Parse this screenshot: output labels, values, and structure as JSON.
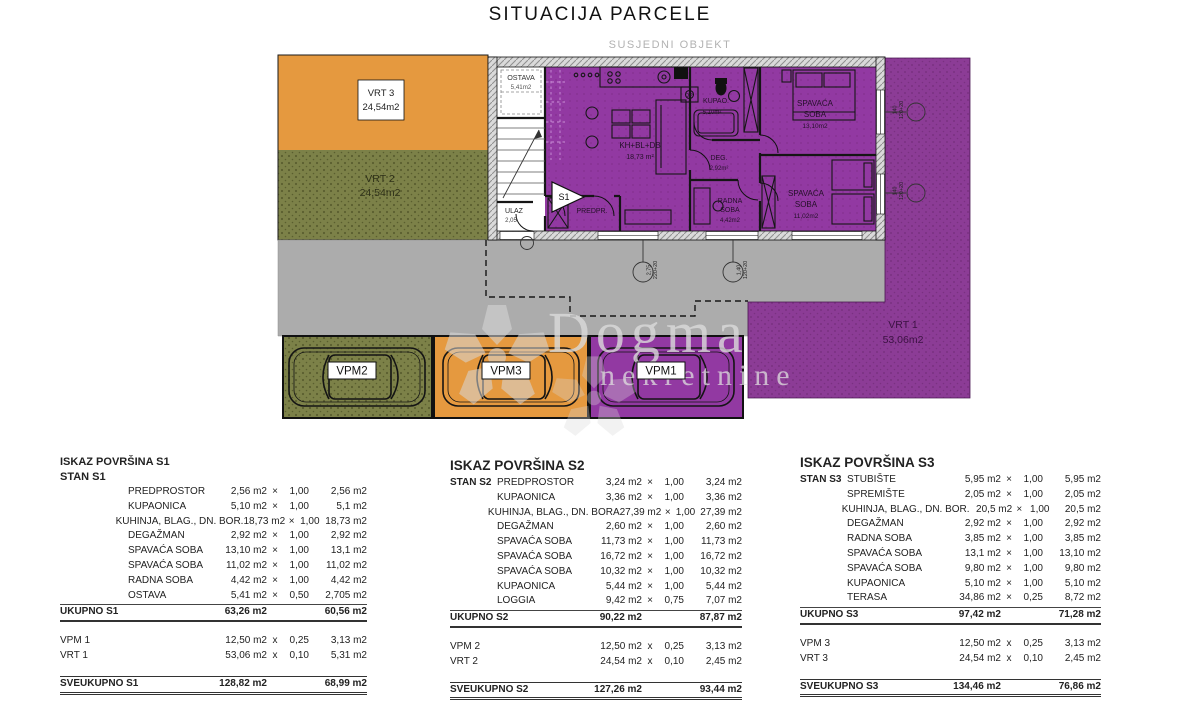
{
  "title": "SITUACIJA PARCELE",
  "site": {
    "neighbor_label": "SUSJEDNI OBJEKT",
    "watermark": {
      "brand": "Dogma",
      "brand2": "nekretnine"
    },
    "areas": {
      "vrt3": {
        "name": "VRT 3",
        "area": "24,54m2"
      },
      "vrt2": {
        "name": "VRT 2",
        "area": "24,54m2"
      },
      "vrt1": {
        "name": "VRT 1",
        "area": "53,06m2"
      }
    },
    "parking": [
      {
        "label": "VPM2"
      },
      {
        "label": "VPM3"
      },
      {
        "label": "VPM1"
      }
    ],
    "plan_labels": {
      "ostava": "OSTAVA",
      "ostava_area": "5,41m2",
      "ulaz": "ULAZ",
      "ulaz_dim": "2,05",
      "marker": "S1",
      "predprostor": "PREDPR.",
      "living": "KH+BL+DB",
      "living_area": "18,73 m²",
      "dp": "DP",
      "kupaonica": "KUPAO.",
      "kupaonica_area": "5,10m²",
      "deg": "DEG.",
      "deg_area": "2,92m²",
      "radna_1": "RADNA",
      "soba": "SOBA",
      "radna_area": "4,42m2",
      "spavaca": "SPAVAĆA",
      "spavaca1_area": "13,10m2",
      "spavaca2_area": "11,02m2"
    },
    "dims": {
      "b1_w": "2,75",
      "b1_h": "220+20",
      "b2_w": "1,40",
      "b2_h": "120+20",
      "r1_w": "140",
      "r1_h": "120+20",
      "r2_w": "140",
      "r2_h": "120+20"
    },
    "colors": {
      "orange": "#E5993F",
      "olive": "#7C8148",
      "purple_plan": "#9239A2",
      "purple_garden": "#8C3C96",
      "driveway_gray": "#ACACAC"
    }
  },
  "tables": [
    {
      "title": "ISKAZ POVRŠINA S1",
      "subtitle": "STAN S1",
      "rows": [
        {
          "g": "",
          "label": "PREDPROSTOR",
          "v": "2,56 m2",
          "m": "×",
          "f": "1,00",
          "r": "2,56 m2"
        },
        {
          "g": "",
          "label": "KUPAONICA",
          "v": "5,10 m2",
          "m": "×",
          "f": "1,00",
          "r": "5,1 m2"
        },
        {
          "g": "",
          "label": "KUHINJA, BLAG., DN. BOR.",
          "v": "18,73 m2",
          "m": "×",
          "f": "1,00",
          "r": "18,73 m2"
        },
        {
          "g": "",
          "label": "DEGAŽMAN",
          "v": "2,92 m2",
          "m": "×",
          "f": "1,00",
          "r": "2,92 m2"
        },
        {
          "g": "",
          "label": "SPAVAĆA SOBA",
          "v": "13,10 m2",
          "m": "×",
          "f": "1,00",
          "r": "13,1 m2"
        },
        {
          "g": "",
          "label": "SPAVAĆA SOBA",
          "v": "11,02 m2",
          "m": "×",
          "f": "1,00",
          "r": "11,02 m2"
        },
        {
          "g": "",
          "label": "RADNA SOBA",
          "v": "4,42 m2",
          "m": "×",
          "f": "1,00",
          "r": "4,42 m2"
        },
        {
          "g": "",
          "label": "OSTAVA",
          "v": "5,41 m2",
          "m": "×",
          "f": "0,50",
          "r": "2,705 m2"
        }
      ],
      "total": {
        "label": "UKUPNO S1",
        "v": "63,26 m2",
        "r": "60,56 m2"
      },
      "extras": [
        {
          "label": "VPM 1",
          "v": "12,50 m2",
          "m": "x",
          "f": "0,25",
          "r": "3,13 m2"
        },
        {
          "label": "VRT 1",
          "v": "53,06 m2",
          "m": "x",
          "f": "0,10",
          "r": "5,31 m2"
        }
      ],
      "grand": {
        "label": "SVEUKUPNO S1",
        "v": "128,82 m2",
        "r": "68,99 m2"
      }
    },
    {
      "title": "ISKAZ POVRŠINA S2",
      "subtitle": "",
      "rows": [
        {
          "g": "STAN S2",
          "label": "PREDPROSTOR",
          "v": "3,24 m2",
          "m": "×",
          "f": "1,00",
          "r": "3,24 m2"
        },
        {
          "g": "",
          "label": "KUPAONICA",
          "v": "3,36 m2",
          "m": "×",
          "f": "1,00",
          "r": "3,36 m2"
        },
        {
          "g": "",
          "label": "KUHINJA, BLAG., DN. BORA",
          "v": "27,39 m2",
          "m": "×",
          "f": "1,00",
          "r": "27,39 m2"
        },
        {
          "g": "",
          "label": "DEGAŽMAN",
          "v": "2,60 m2",
          "m": "×",
          "f": "1,00",
          "r": "2,60 m2"
        },
        {
          "g": "",
          "label": "SPAVAĆA SOBA",
          "v": "11,73 m2",
          "m": "×",
          "f": "1,00",
          "r": "11,73 m2"
        },
        {
          "g": "",
          "label": "SPAVAĆA SOBA",
          "v": "16,72 m2",
          "m": "×",
          "f": "1,00",
          "r": "16,72 m2"
        },
        {
          "g": "",
          "label": "SPAVAĆA SOBA",
          "v": "10,32 m2",
          "m": "×",
          "f": "1,00",
          "r": "10,32 m2"
        },
        {
          "g": "",
          "label": "KUPAONICA",
          "v": "5,44 m2",
          "m": "×",
          "f": "1,00",
          "r": "5,44 m2"
        },
        {
          "g": "",
          "label": "LOGGIA",
          "v": "9,42 m2",
          "m": "×",
          "f": "0,75",
          "r": "7,07 m2"
        }
      ],
      "total": {
        "label": "UKUPNO S2",
        "v": "90,22 m2",
        "r": "87,87 m2"
      },
      "extras": [
        {
          "label": "VPM 2",
          "v": "12,50 m2",
          "m": "x",
          "f": "0,25",
          "r": "3,13 m2"
        },
        {
          "label": "VRT 2",
          "v": "24,54 m2",
          "m": "x",
          "f": "0,10",
          "r": "2,45 m2"
        }
      ],
      "grand": {
        "label": "SVEUKUPNO S2",
        "v": "127,26 m2",
        "r": "93,44 m2"
      }
    },
    {
      "title": "ISKAZ POVRŠINA S3",
      "subtitle": "",
      "rows": [
        {
          "g": "STAN S3",
          "label": "STUBIŠTE",
          "v": "5,95 m2",
          "m": "×",
          "f": "1,00",
          "r": "5,95 m2"
        },
        {
          "g": "",
          "label": "SPREMIŠTE",
          "v": "2,05 m2",
          "m": "×",
          "f": "1,00",
          "r": "2,05 m2"
        },
        {
          "g": "",
          "label": "KUHINJA, BLAG., DN. BOR.",
          "v": "20,5 m2",
          "m": "×",
          "f": "1,00",
          "r": "20,5 m2"
        },
        {
          "g": "",
          "label": "DEGAŽMAN",
          "v": "2,92 m2",
          "m": "×",
          "f": "1,00",
          "r": "2,92 m2"
        },
        {
          "g": "",
          "label": "RADNA SOBA",
          "v": "3,85 m2",
          "m": "×",
          "f": "1,00",
          "r": "3,85 m2"
        },
        {
          "g": "",
          "label": "SPAVAĆA SOBA",
          "v": "13,1 m2",
          "m": "×",
          "f": "1,00",
          "r": "13,10 m2"
        },
        {
          "g": "",
          "label": "SPAVAĆA SOBA",
          "v": "9,80 m2",
          "m": "×",
          "f": "1,00",
          "r": "9,80 m2"
        },
        {
          "g": "",
          "label": "KUPAONICA",
          "v": "5,10 m2",
          "m": "×",
          "f": "1,00",
          "r": "5,10 m2"
        },
        {
          "g": "",
          "label": "TERASA",
          "v": "34,86 m2",
          "m": "×",
          "f": "0,25",
          "r": "8,72 m2"
        }
      ],
      "total": {
        "label": "UKUPNO S3",
        "v": "97,42 m2",
        "r": "71,28 m2"
      },
      "extras": [
        {
          "label": "VPM 3",
          "v": "12,50 m2",
          "m": "x",
          "f": "0,25",
          "r": "3,13 m2"
        },
        {
          "label": "VRT 3",
          "v": "24,54 m2",
          "m": "x",
          "f": "0,10",
          "r": "2,45 m2"
        }
      ],
      "grand": {
        "label": "SVEUKUPNO S3",
        "v": "134,46 m2",
        "r": "76,86 m2"
      }
    }
  ]
}
